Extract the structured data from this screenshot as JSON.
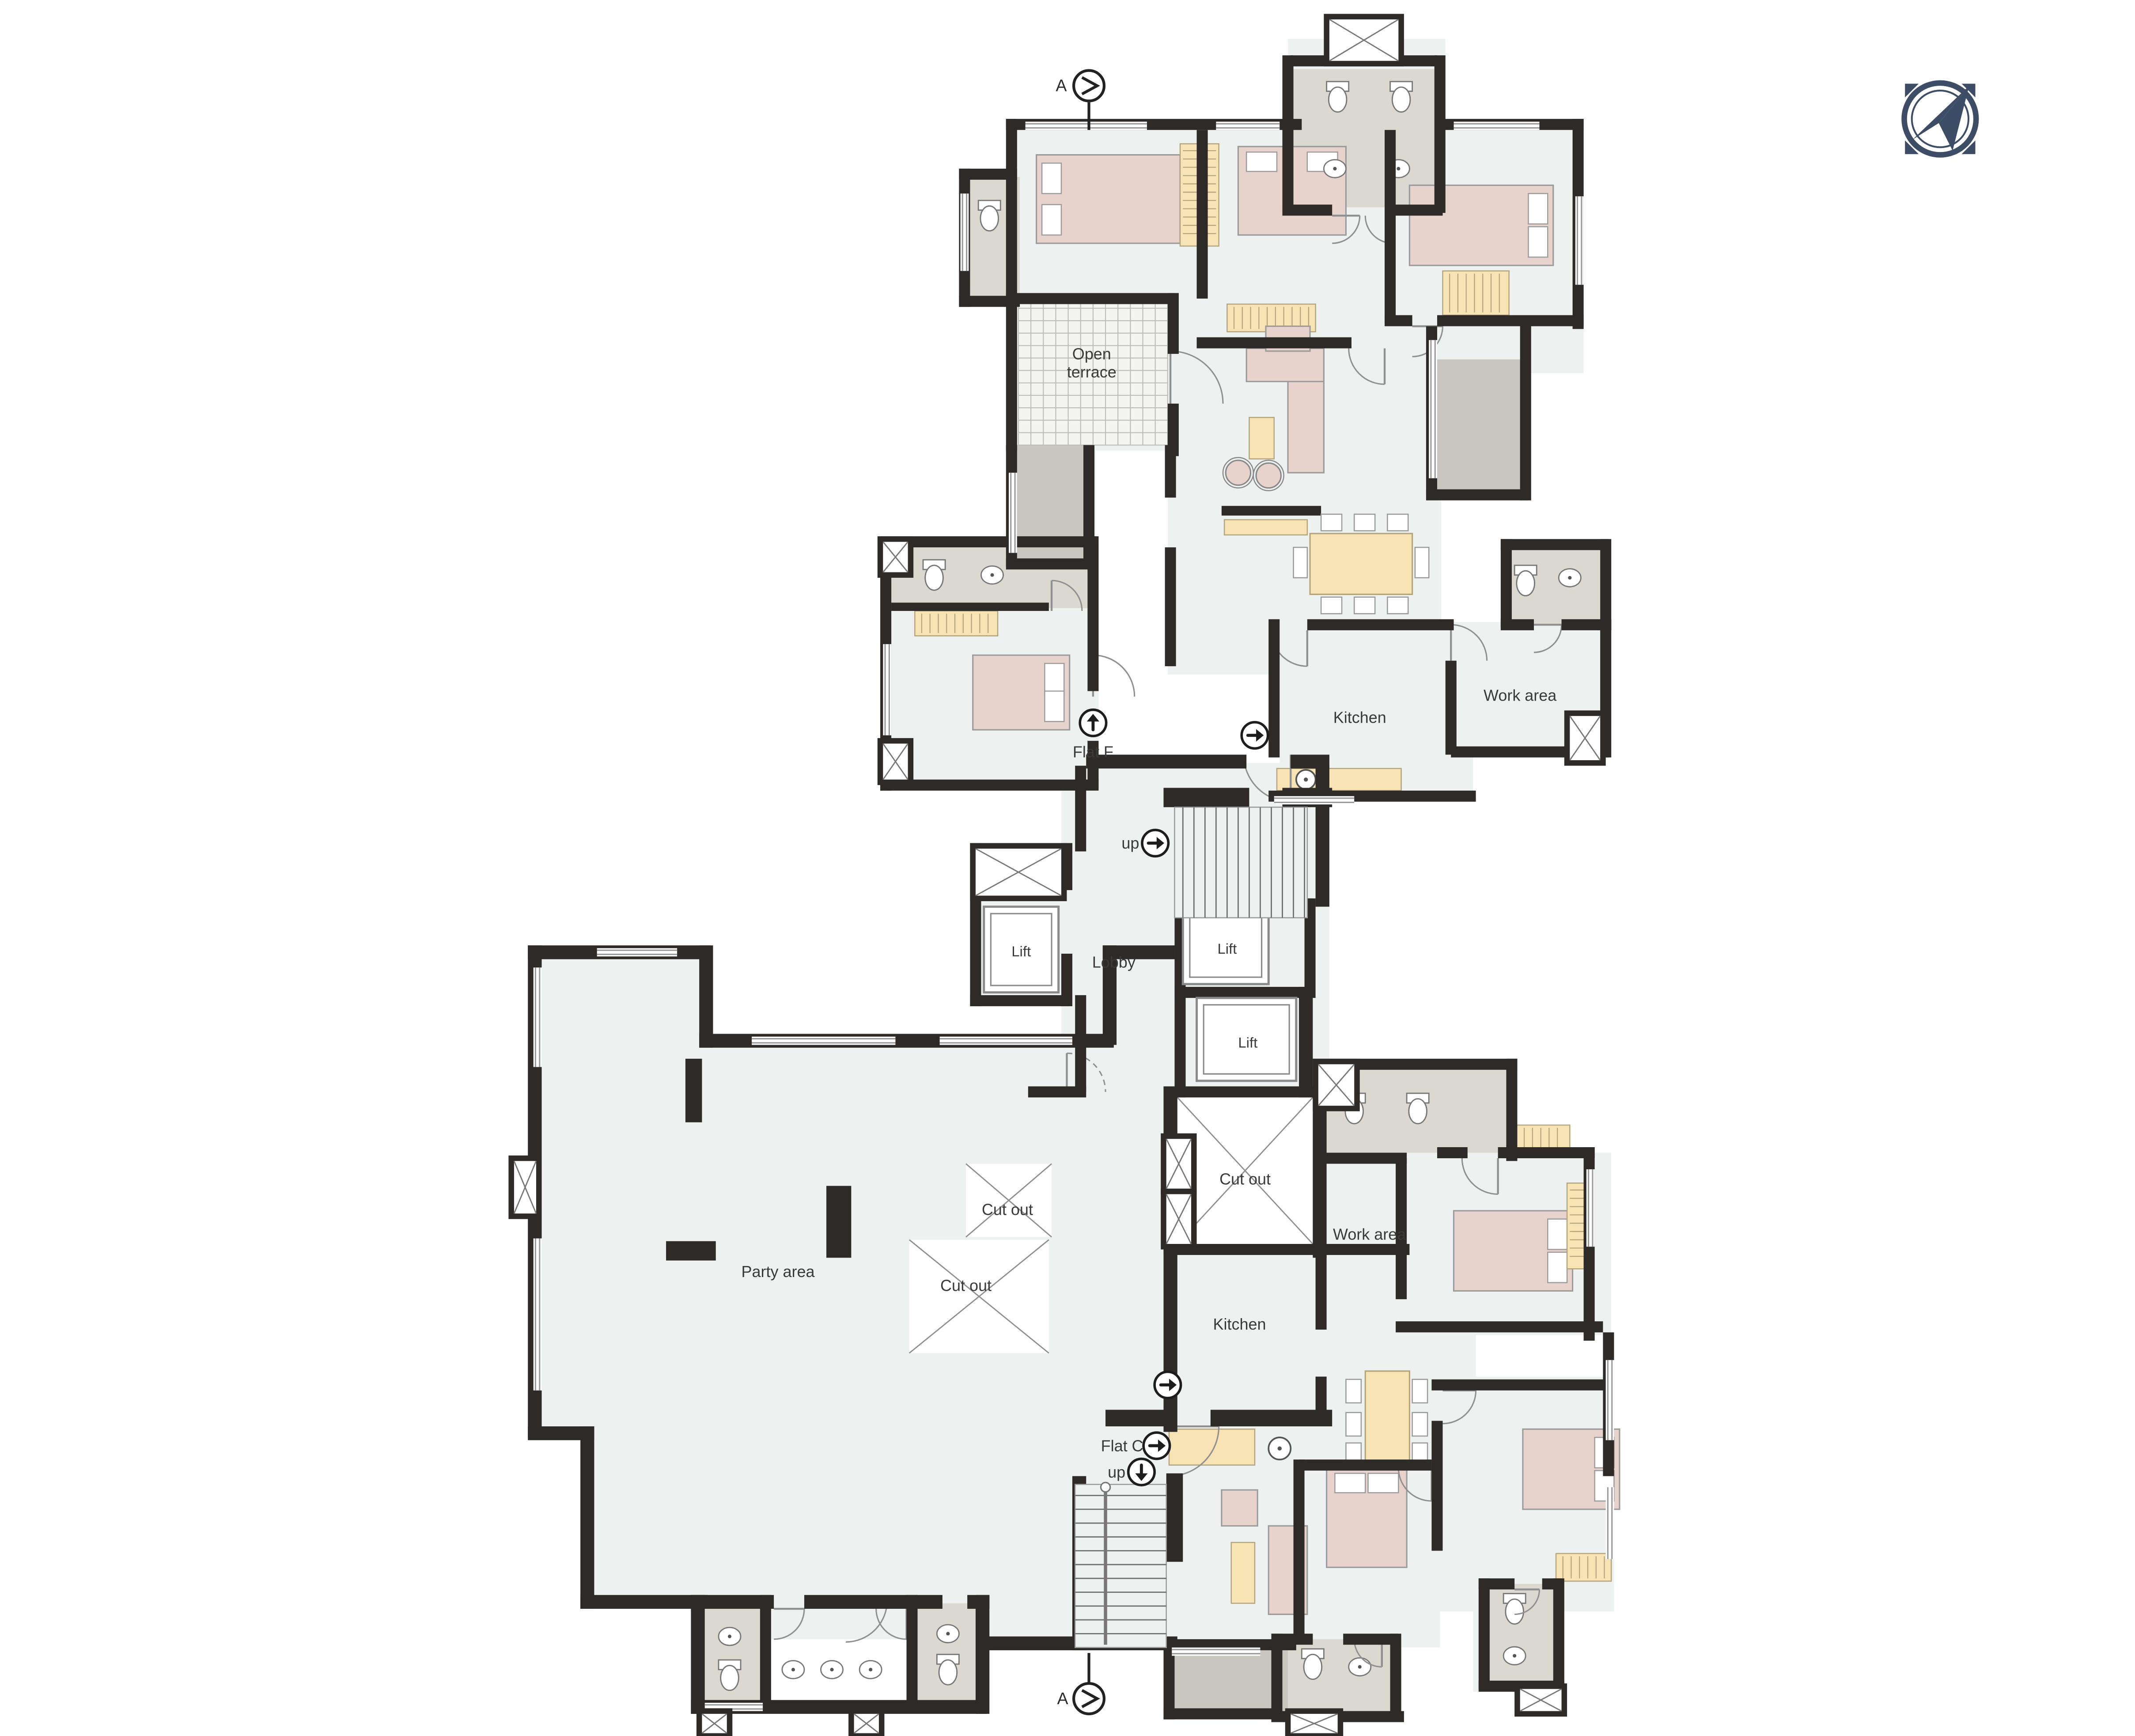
{
  "title": "Building floor plan",
  "colors": {
    "wall": "#2d2a27",
    "floor": "#edf2f1",
    "bath": "#dbd8d0",
    "terrace": "#c9c6c0",
    "tile": "#f4f4f2",
    "bed": "#e7d2cc",
    "tan": "#f7e3b4",
    "line": "#8f8f8f",
    "compass": "#3d4d66",
    "label": "#3a3a3a"
  },
  "labels": {
    "open_line1": "Open",
    "open_line2": "terrace",
    "flat_f": "Flat F",
    "kitchen_upper": "Kitchen",
    "work_upper": "Work area",
    "up_upper": "up",
    "lobby": "Lobby",
    "lift_left": "Lift",
    "lift_top": "Lift",
    "lift_bottom": "Lift",
    "cutout_center": "Cut out",
    "cutout_upper": "Cut out",
    "cutout_lower": "Cut out",
    "party": "Party area",
    "work_lower": "Work area",
    "kitchen_lower": "Kitchen",
    "flat_c": "Flat C",
    "up_lower": "up",
    "section_top": "A",
    "section_bottom": "A"
  },
  "icons": {
    "compass": "north-compass",
    "section_marker": "circled-chevron-right",
    "flat_f_arrow": "up-arrow",
    "flat_c_arrow": "right-arrow",
    "up_upper_arrow": "right-arrow",
    "up_lower_arrow": "down-arrow",
    "entry_arrows": "right-arrow"
  }
}
